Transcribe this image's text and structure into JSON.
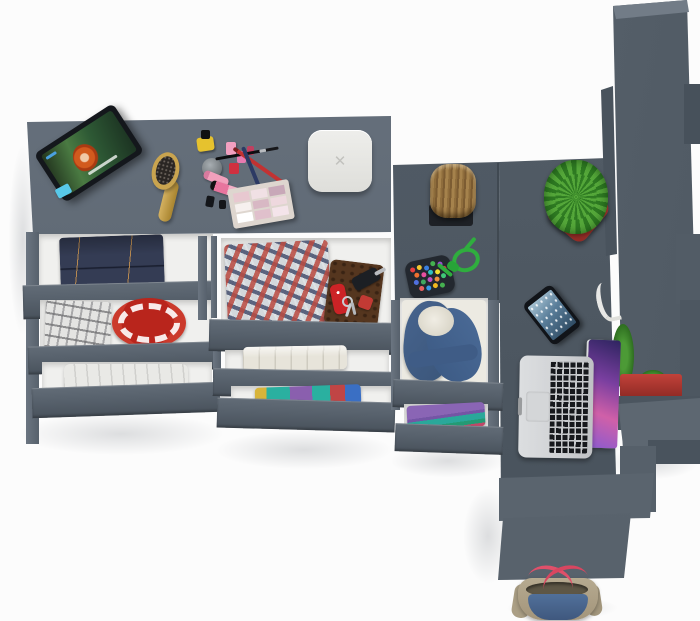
{
  "scene": {
    "description": "Top-down 3D render of an anthracite-gray youth room furniture set: long dresser with cosmetics and tablet on top, three columns of open drawers with folded clothes, connected desk with laptop and smartphone, tree-stump stool, tall wardrobe tower, cactus planters and a tote bag on the floor",
    "background_color": "#fcfcfc",
    "furniture_color": "#57616c"
  },
  "scale": {
    "mark": "✕",
    "color": "#e9e9e6"
  },
  "palette": {
    "desk_top": "#5d6772",
    "drawer_front": "#57616c",
    "drawer_interior": "#f0f0ee",
    "dark_surface": "#4e5862",
    "wardrobe": "#5a646f",
    "accent_red": "#b9251c",
    "planter_red": "#b2362c",
    "cactus_green": "#55a83a",
    "rope_green": "#2fae3e",
    "denim_blue": "#47648e",
    "wood_tan": "#a5824c",
    "laptop_silver": "#d9dbdd",
    "bag_beige": "#b6aa90",
    "strap_pink": "#e0506a"
  },
  "objects": [
    {
      "name": "tablet",
      "detail": "propped on dresser, playing a movie with a red-haired character",
      "color": "#14171c"
    },
    {
      "name": "sticky-notes",
      "color": "#58c8e8"
    },
    {
      "name": "hairbrush",
      "color": "#c9a44f"
    },
    {
      "name": "cosmetics-set",
      "detail": "nail polishes, jar, lipstick tubes, pencils, brush, eyeshadow palette"
    },
    {
      "name": "white-scale",
      "detail": "rounded square box marked with an X",
      "color": "#e9e9e6"
    },
    {
      "name": "folded-jeans",
      "color": "#343c54"
    },
    {
      "name": "gray-plaid-shirt",
      "color": "#e4e4e2"
    },
    {
      "name": "red-plate",
      "detail": "red dish with white rim pattern",
      "color": "#b9251c"
    },
    {
      "name": "white-linen",
      "color": "#e9e9e6"
    },
    {
      "name": "red-blue-plaid-shirt",
      "color": "#d3d8dc"
    },
    {
      "name": "leather-wallet",
      "color": "#5e3c25"
    },
    {
      "name": "swiss-army-knife",
      "color": "#cc2326"
    },
    {
      "name": "car-key-and-keys",
      "color": "#1c1f24"
    },
    {
      "name": "cream-towel",
      "color": "#e7e4da"
    },
    {
      "name": "colorful-clothes-stack",
      "colors": [
        "#2ab0a0",
        "#8a5fae",
        "#d8b43a",
        "#c04545",
        "#3a6fc4"
      ]
    },
    {
      "name": "tree-stump-stool",
      "color": "#a5824c"
    },
    {
      "name": "bead-pouch-with-green-rope",
      "colors": [
        "#e84040",
        "#f2c730",
        "#3a7fe0",
        "#45b050",
        "#9a4fd0",
        "#2fae3e"
      ]
    },
    {
      "name": "denim-jacket-in-drawer",
      "color": "#47648e"
    },
    {
      "name": "purple-teal-clothes-stack",
      "colors": [
        "#8a65b5",
        "#2aa89a"
      ]
    },
    {
      "name": "smartphone",
      "detail": "screen on, bluish wallpaper",
      "color": "#111419"
    },
    {
      "name": "earphones",
      "color": "#e8e8e6"
    },
    {
      "name": "macbook-laptop",
      "detail": "open, purple galaxy wallpaper",
      "color": "#d9dbdd"
    },
    {
      "name": "cactus-in-red-pot",
      "colors": [
        "#55a83a",
        "#b2362c"
      ]
    },
    {
      "name": "wardrobe-tower",
      "color": "#5a646f"
    },
    {
      "name": "second-red-planter",
      "color": "#b2362c"
    },
    {
      "name": "tote-bag",
      "detail": "beige and denim tote with pink straps",
      "colors": [
        "#b6aa90",
        "#51709a",
        "#e0506a"
      ]
    }
  ]
}
